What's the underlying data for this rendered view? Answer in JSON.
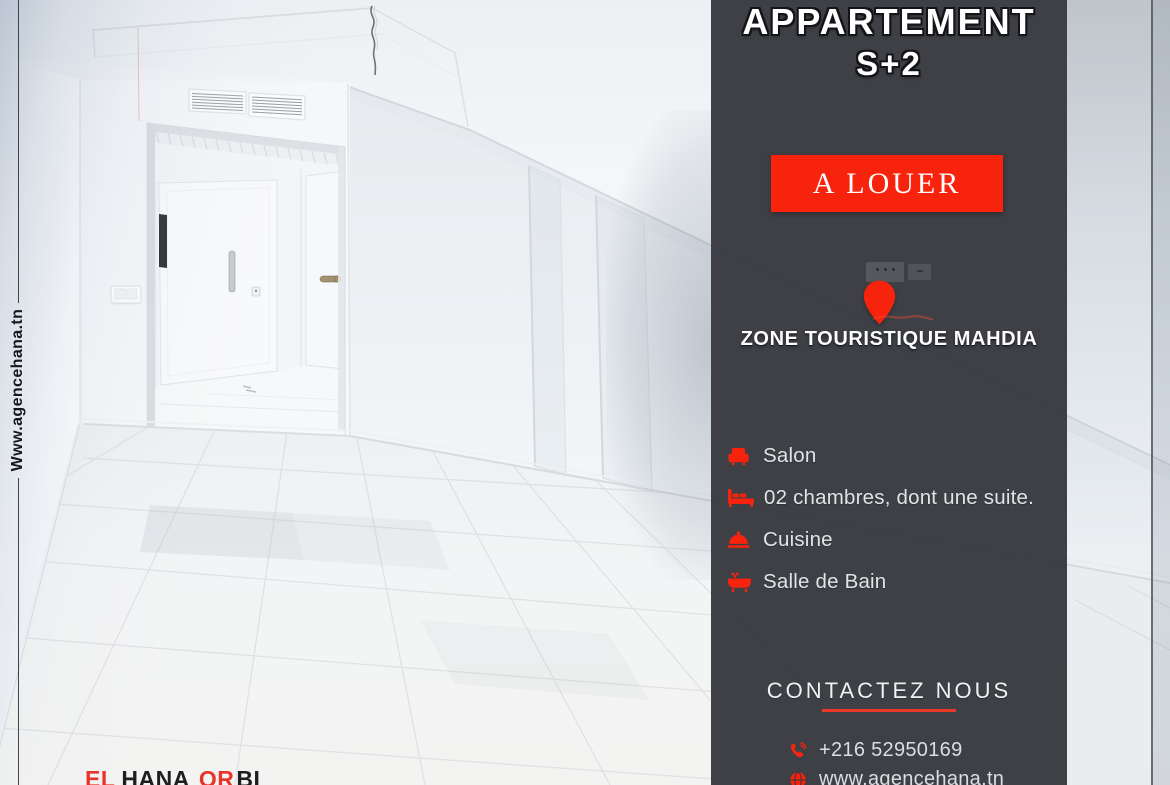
{
  "brand": {
    "watermark_url": "Www.agencehana.tn",
    "logo_segments": [
      {
        "text": "EL",
        "color": "red"
      },
      {
        "text": "HANA",
        "color": "dark"
      },
      {
        "text": "OR",
        "color": "red"
      },
      {
        "text": "BI",
        "color": "dark"
      }
    ]
  },
  "panel": {
    "title_line1": "APPARTEMENT",
    "title_line2": "S+2",
    "badge": "A LOUER",
    "location_icon": "location-pin-icon",
    "location": "ZONE TOURISTIQUE MAHDIA",
    "features": [
      {
        "icon": "sofa-icon",
        "label": "Salon"
      },
      {
        "icon": "bed-icon",
        "label": "02 chambres, dont une suite."
      },
      {
        "icon": "cloche-icon",
        "label": "Cuisine"
      },
      {
        "icon": "bathtub-icon",
        "label": "Salle de Bain"
      }
    ],
    "contact": {
      "heading": "CONTACTEZ NOUS",
      "phone_icon": "phone-icon",
      "phone": "+216 52950169",
      "website_icon": "globe-icon",
      "website": "www.agencehana.tn"
    }
  },
  "colors": {
    "accent_red": "#f7230c",
    "underline_red": "#e9382a",
    "panel_bg": "#35373e",
    "text_light": "#e2e3e6",
    "logo_red": "#e8342a",
    "logo_dark": "#1d1e20",
    "watermark_color": "#17181a"
  }
}
